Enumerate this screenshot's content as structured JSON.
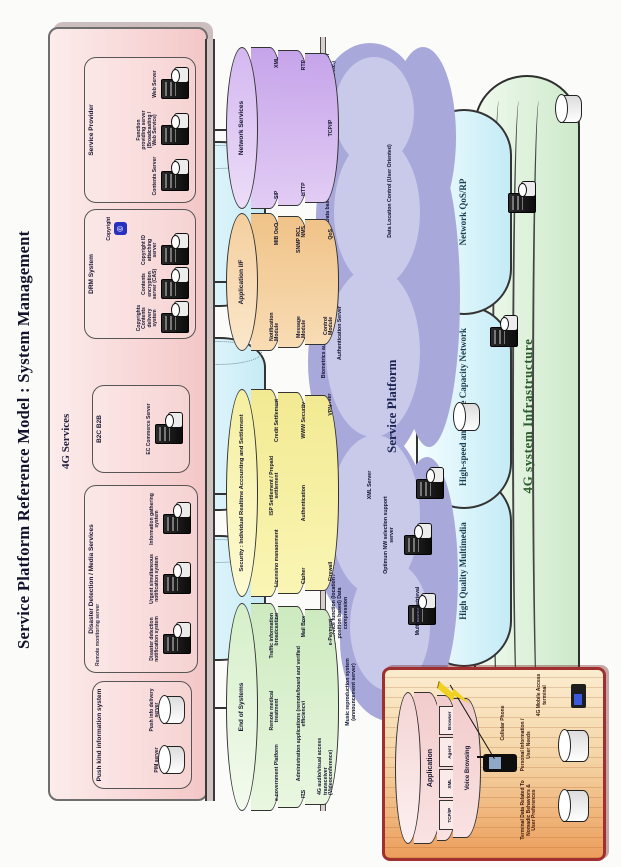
{
  "title": "Service Platform Reference Model : System Management",
  "panel": {
    "label": "4G Services",
    "boxes": [
      {
        "title": "Push kind information system",
        "servers": [
          "PIM server",
          "Push info delivery server"
        ]
      },
      {
        "title": "Disaster Detection / Media Services",
        "note": "Remote monitoring server",
        "servers": [
          "Disaster detection notification system",
          "Urgent simultaneous notification system",
          "Information gathering system"
        ]
      },
      {
        "title": "B2C B2B",
        "servers": [
          "EC Commerce Server"
        ]
      },
      {
        "title": "DRM System",
        "badge": "Copyright",
        "badge_glyph": "©",
        "servers": [
          "Copyrights Contents delivery system",
          "Contents encryption server (CAS)",
          "Copyright ID attaching server"
        ]
      },
      {
        "title": "Service Provider",
        "servers": [
          "Contents Server",
          "Function providing server (Broadcasting / Web Service)",
          "Web Server"
        ]
      }
    ]
  },
  "stacks": [
    {
      "title": "End of Systems",
      "bands": [
        [
          "e-government Platform",
          "Remote medical treatment",
          "Traffic information broadcasting"
        ],
        [
          "ITS",
          "Administration applications (remote/board and verified efficiency)",
          "Mail Box"
        ],
        [
          "4G audio/visual access transceiver (Videoconference)",
          "",
          "e-Payment"
        ]
      ]
    },
    {
      "title": "Security : Individual Realtime Accounting and Settlement",
      "bands": [
        [
          "Licensing management",
          "ISP Settlement / Prepaid settlement",
          "Credit Settlement"
        ],
        [
          "Cipher",
          "Authentication",
          "WWW Security"
        ],
        [
          "Firewall",
          "",
          "VPN"
        ]
      ]
    },
    {
      "title": "Application I/F",
      "bands": [
        [
          "Notification Module",
          "",
          "MIB QoO"
        ],
        [
          "Message Module",
          "",
          "SNMP RCL NMS"
        ],
        [
          "Control Module",
          "",
          "QoS"
        ]
      ]
    },
    {
      "title": "Network Services",
      "bands": [
        [
          "SIP",
          "",
          "XML"
        ],
        [
          "HTTP",
          "",
          "RTP"
        ],
        [
          "",
          "TCP/IP",
          ""
        ]
      ]
    }
  ],
  "cloud": {
    "label": "Service Platform",
    "servers": {
      "music": "Music reproduction system (announcement server)",
      "multimedia_note": "Map service function (location / position based) Data compression",
      "multimedia": "Multimedia retrieval",
      "optimum": "Optimum NW selection support server",
      "xml": "XML Server",
      "mailbox": "Mail Box Server",
      "auth_note": "Biometrics authentication functions",
      "auth": "Authentication Server",
      "db": "Data base Portal Server",
      "db_note": "Data Location Control (User Oriented)",
      "pim": "Personal Identification Management (User Profile, User Behavior Info and etc.)"
    }
  },
  "network_layers": [
    {
      "label": "High Quality Multimedia"
    },
    {
      "label": "High-speed and Large Capacity Network"
    },
    {
      "label": "Network QoS/RP"
    }
  ],
  "infrastructure": {
    "label": "4G system Infrastructure"
  },
  "terminal": {
    "stack": {
      "app": "Application",
      "segments": [
        "TCP/IP",
        "XML",
        "Agent",
        "Browser"
      ],
      "voice": "Voice Browsing"
    },
    "phone": "Cellular Phone",
    "cyl1": "Personal Information / User Needs",
    "cyl2": "Terminal Data Related To Nomadic Behaviors & User Preferences",
    "access": "4G Mobile Access terminal"
  },
  "colors": {
    "panel_pink": "#f7d2d2",
    "stack_green": "#dff3d6",
    "stack_yellow": "#f8f3a6",
    "stack_orange": "#f6d0a0",
    "stack_purple": "#d9c2f0",
    "cloud": "#a8a8da",
    "network_blue": "#d6f0f8",
    "infra_green": "#d9efd6",
    "terminal_orange": "#f2b176",
    "terminal_border_red": "#a03030"
  }
}
